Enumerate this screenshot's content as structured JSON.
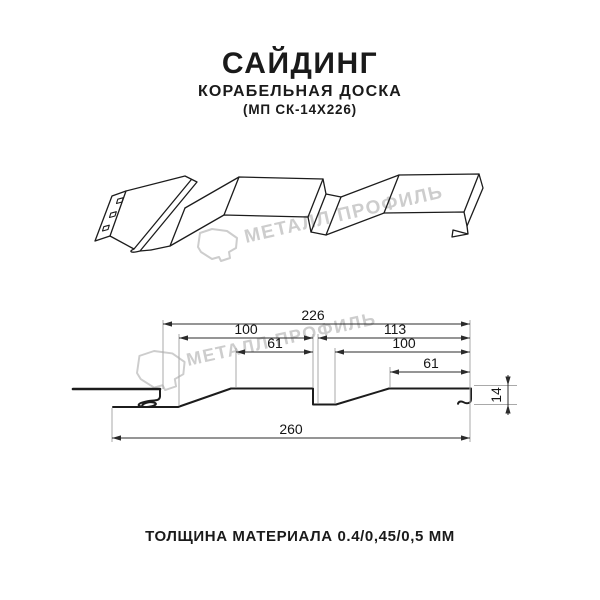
{
  "header": {
    "title": "САЙДИНГ",
    "subtitle": "КОРАБЕЛЬНАЯ ДОСКА",
    "model": "(МП СК-14Х226)"
  },
  "watermark": {
    "text": "МЕТАЛЛ ПРОФИЛЬ",
    "color": "#cdcdcd",
    "logo": "metall-profil-stone"
  },
  "drawing": {
    "dimensions": {
      "top_width": "226",
      "upper_left": "100",
      "inner_left": "61",
      "upper_right": "113",
      "inner_right": "100",
      "small_right": "61",
      "bottom_width": "260",
      "height": "14"
    }
  },
  "footer": {
    "thickness_label": "ТОЛЩИНА МАТЕРИАЛА 0.4/0,45/0,5 ММ"
  },
  "colors": {
    "background": "#ffffff",
    "line": "#1c1c1c",
    "dimension": "#2b2b2b",
    "extension": "#a9a9a9",
    "watermark": "#cdcdcd",
    "text": "#1a1a1a"
  }
}
